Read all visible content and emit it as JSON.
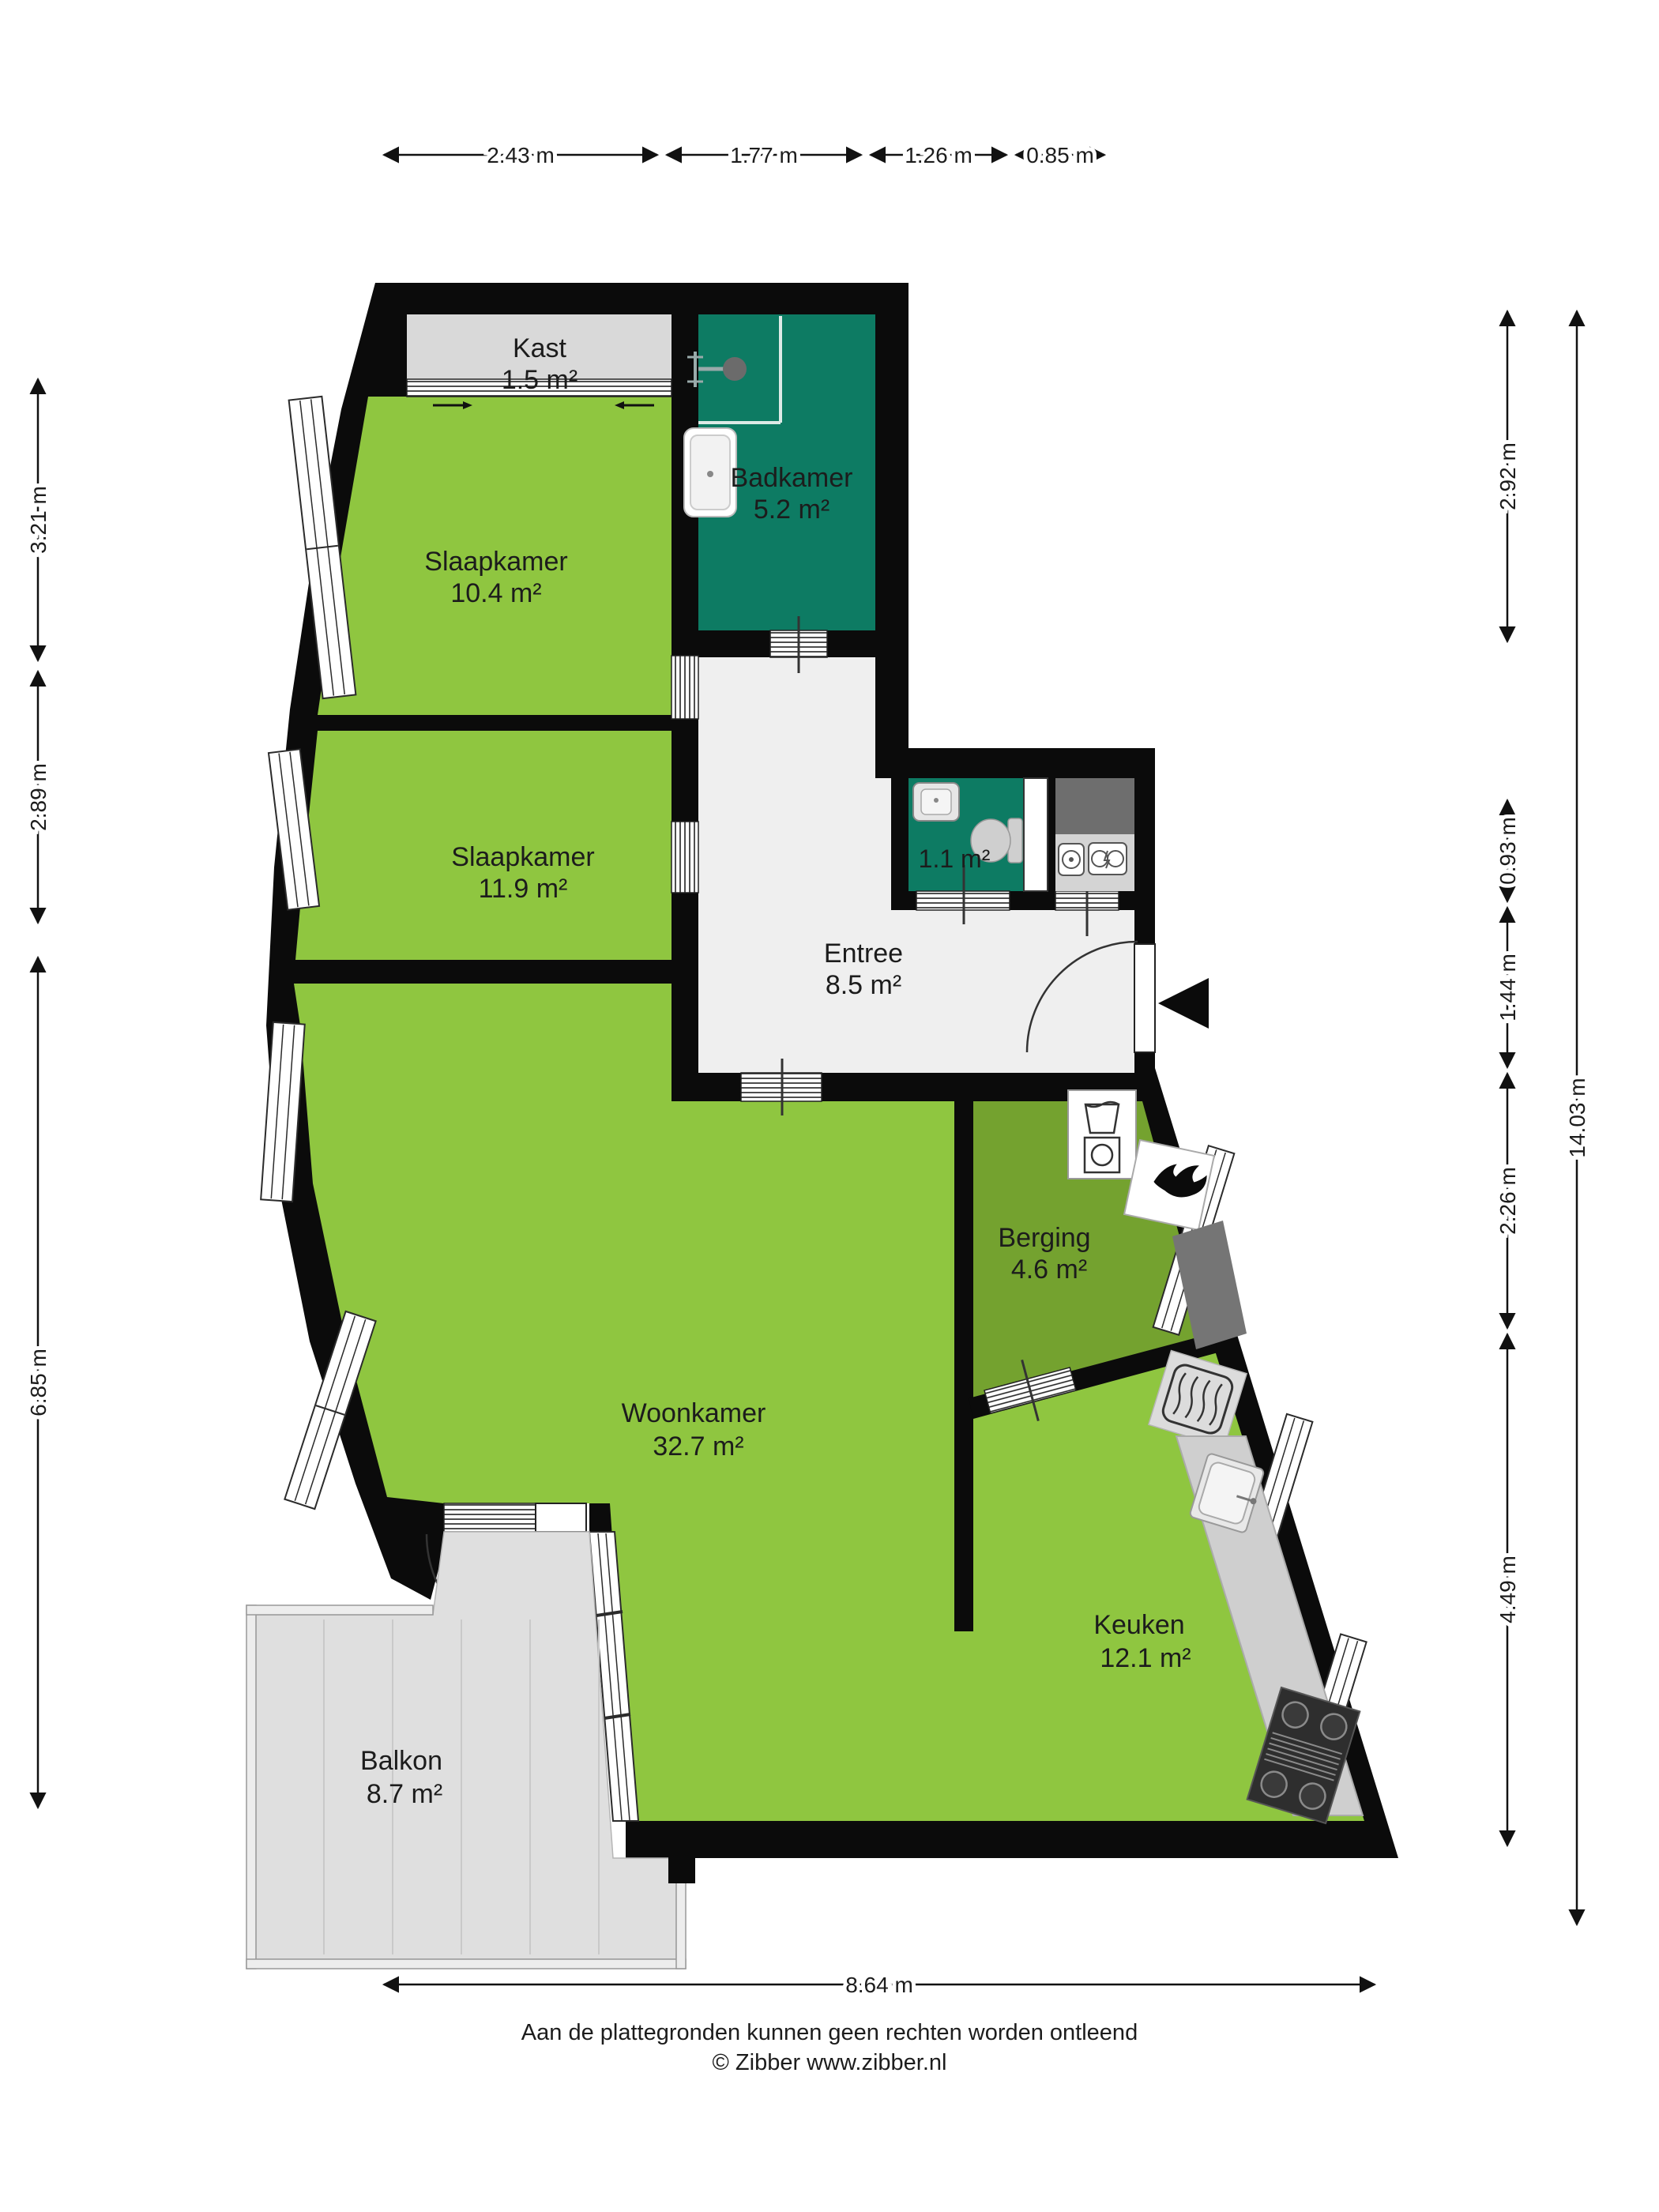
{
  "plan": {
    "type": "floorplan",
    "language": "Dutch",
    "rooms": {
      "kast": {
        "name": "Kast",
        "area": "1.5 m²"
      },
      "badkamer": {
        "name": "Badkamer",
        "area": "5.2 m²"
      },
      "slaapkamer1": {
        "name": "Slaapkamer",
        "area": "10.4 m²"
      },
      "slaapkamer2": {
        "name": "Slaapkamer",
        "area": "11.9 m²"
      },
      "toilet": {
        "name": "",
        "area": "1.1 m²"
      },
      "entree": {
        "name": "Entree",
        "area": "8.5 m²"
      },
      "berging": {
        "name": "Berging",
        "area": "4.6 m²"
      },
      "woonkamer": {
        "name": "Woonkamer",
        "area": "32.7 m²"
      },
      "keuken": {
        "name": "Keuken",
        "area": "12.1 m²"
      },
      "balkon": {
        "name": "Balkon",
        "area": "8.7 m²"
      }
    },
    "dimensions": {
      "top": [
        "2.43 m",
        "1.77 m",
        "1.26 m",
        "0.85 m"
      ],
      "left": [
        "3.21 m",
        "2.89 m",
        "6.85 m"
      ],
      "right": [
        "2.92 m",
        "0.93 m",
        "1.44 m",
        "2.26 m",
        "4.49 m"
      ],
      "right_total": "14.03 m",
      "bottom": "8.64 m"
    },
    "icons": [
      "shower-icon",
      "bathtub-icon",
      "toilet-icon",
      "hand-sink-icon",
      "water-meter-icon",
      "electricity-meter-icon",
      "washing-machine-icon",
      "boiler-icon",
      "radiator-icon",
      "kitchen-sink-icon",
      "stove-icon",
      "entrance-arrow-icon"
    ],
    "colors": {
      "floor_light_green": "#8FC640",
      "floor_dark_green": "#74A22F",
      "wet_room_teal": "#0D7B63",
      "wall_black": "#0B0B0B",
      "closet_gray": "#D9D9D9",
      "balcony_gray": "#DFDFDF",
      "entree_gray": "#EFEFEF",
      "counter_gray": "#CFCFCF",
      "meter_closet_gray": "#6E6E6E"
    },
    "footer": {
      "disclaimer": "Aan de plattegronden kunnen geen rechten worden ontleend",
      "copyright": "© Zibber www.zibber.nl"
    }
  }
}
